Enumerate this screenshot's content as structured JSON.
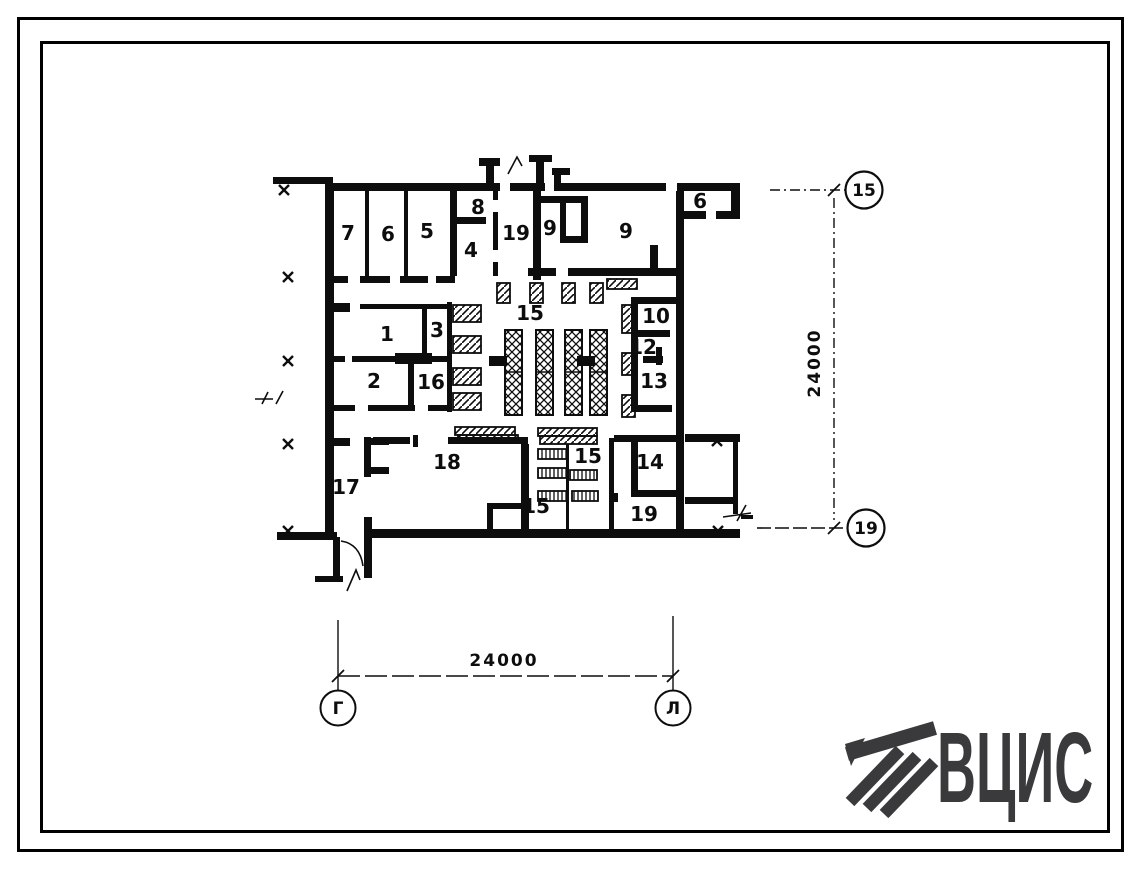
{
  "page": {
    "background": "#ffffff",
    "line_color": "#0d0d0d"
  },
  "plan": {
    "room_labels": [
      {
        "text": "7",
        "x": 348,
        "y": 233
      },
      {
        "text": "6",
        "x": 388,
        "y": 234
      },
      {
        "text": "5",
        "x": 427,
        "y": 231
      },
      {
        "text": "8",
        "x": 478,
        "y": 207,
        "size": 18
      },
      {
        "text": "4",
        "x": 471,
        "y": 250
      },
      {
        "text": "19",
        "x": 516,
        "y": 233
      },
      {
        "text": "9",
        "x": 550,
        "y": 228,
        "size": 18
      },
      {
        "text": "9",
        "x": 626,
        "y": 231,
        "size": 27
      },
      {
        "text": "9",
        "x": 700,
        "y": 200,
        "size": 18,
        "rot": 180
      },
      {
        "text": "1",
        "x": 387,
        "y": 334
      },
      {
        "text": "3",
        "x": 437,
        "y": 330
      },
      {
        "text": "2",
        "x": 374,
        "y": 381
      },
      {
        "text": "16",
        "x": 431,
        "y": 382
      },
      {
        "text": "15",
        "x": 530,
        "y": 313,
        "size": 23
      },
      {
        "text": "10",
        "x": 656,
        "y": 316
      },
      {
        "text": "12",
        "x": 643,
        "y": 347
      },
      {
        "text": "13",
        "x": 654,
        "y": 381
      },
      {
        "text": "14",
        "x": 650,
        "y": 462
      },
      {
        "text": "17",
        "x": 346,
        "y": 487
      },
      {
        "text": "18",
        "x": 447,
        "y": 462
      },
      {
        "text": "15",
        "x": 588,
        "y": 456
      },
      {
        "text": "15",
        "x": 536,
        "y": 506
      },
      {
        "text": "19",
        "x": 644,
        "y": 514
      }
    ],
    "dimensions": {
      "bottom": {
        "value": "24000"
      },
      "right": {
        "value": "24000"
      }
    },
    "axes": {
      "right_top": "15",
      "right_bottom": "19",
      "bottom_left": "Г",
      "bottom_right": "Л"
    }
  },
  "logo": {
    "text": "ВЦИС",
    "color": "#3a3a3c"
  }
}
